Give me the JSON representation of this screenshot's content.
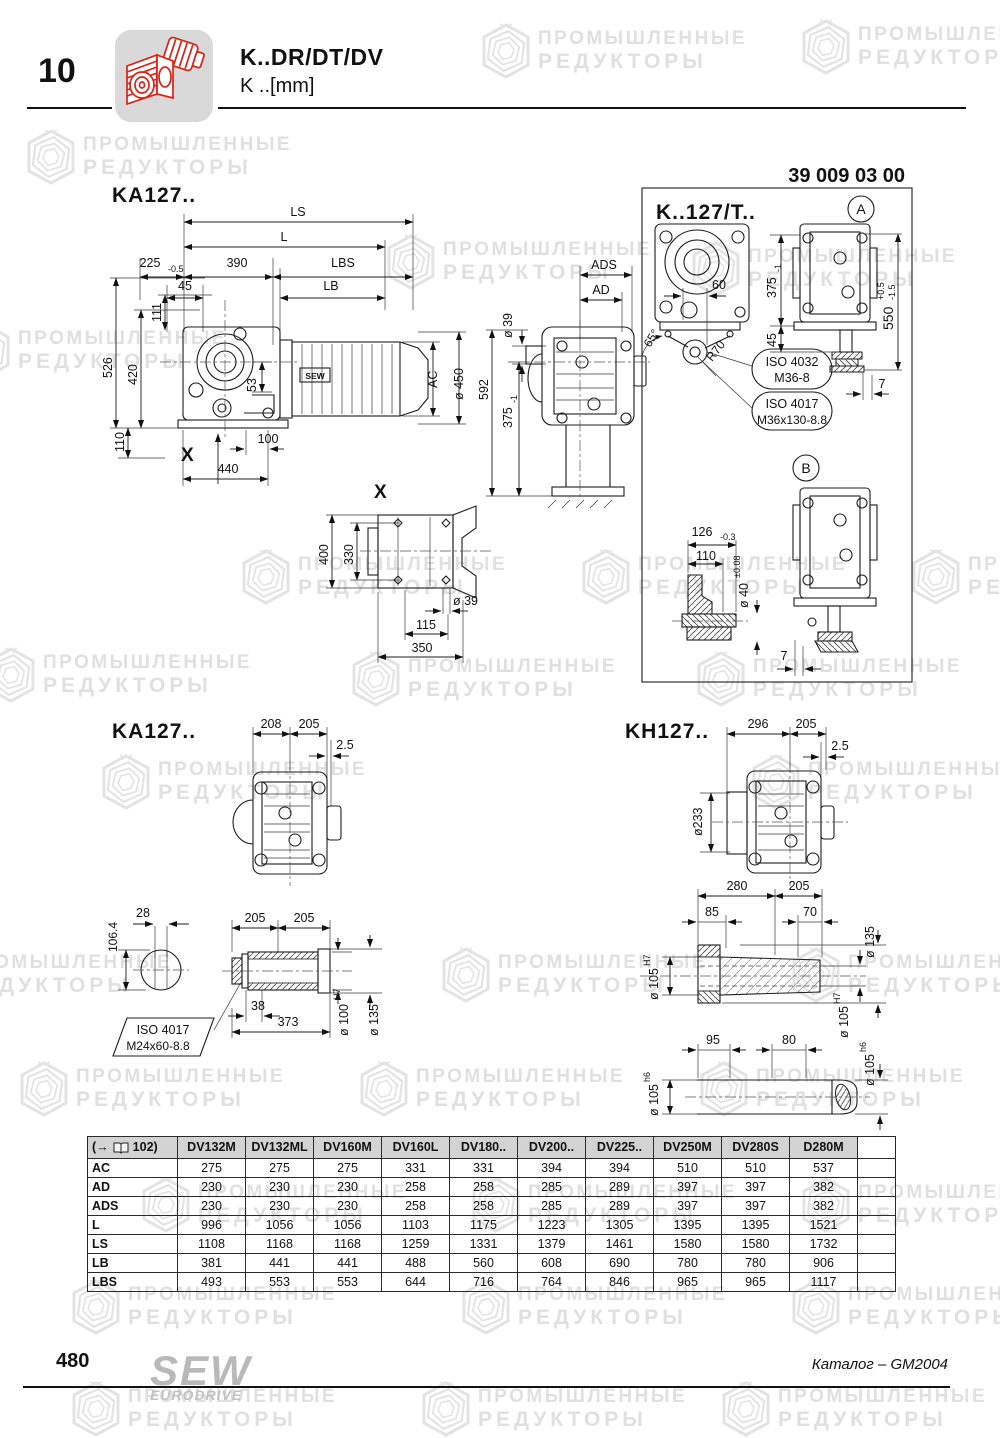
{
  "header": {
    "section_number": "10",
    "title": "K..DR/DT/DV",
    "subtitle": "K ..[mm]",
    "part_number": "39 009 03 00"
  },
  "watermark": {
    "line1": "ПРОМЫШЛЕННЫЕ",
    "line2": "РЕДУКТОРЫ"
  },
  "drawings": {
    "ka127_top": {
      "title": "KA127..",
      "motor_label": "SEW",
      "section_marker": "X",
      "dims": {
        "ls": "LS",
        "l": "L",
        "d225": "225",
        "d225_tol": "-0.5",
        "d390": "390",
        "lbs": "LBS",
        "d45": "45",
        "lb": "LB",
        "d111": "111",
        "d526": "526",
        "d420": "420",
        "d53": "53",
        "d110": "110",
        "d440": "440",
        "d100": "100",
        "ac": "AC",
        "d450": "ø 450"
      }
    },
    "rear": {
      "dims": {
        "ads": "ADS",
        "ad": "AD",
        "d39": "ø 39",
        "d592": "592",
        "d375": "375",
        "d375_tol": "-1"
      }
    },
    "x_view": {
      "title": "X",
      "dims": {
        "d400": "400",
        "d330": "330",
        "d39": "ø 39",
        "d115": "115",
        "d350": "350"
      }
    },
    "k127t": {
      "title": "K..127/T..",
      "marker_a": "A",
      "marker_b": "B",
      "dims": {
        "d60": "60",
        "a65": "65°",
        "r70": "R70",
        "d375": "375",
        "d375_tol": "-1",
        "d45": "45",
        "d550": "550",
        "d550_tol_up": "+0.5",
        "d550_tol_dn": "-1.5",
        "d7a": "7",
        "d126": "126",
        "d126_tol": "-0.3",
        "d110": "110",
        "d40": "ø 40",
        "d40_tol": "±0.08",
        "d7b": "7"
      },
      "callout1": {
        "line1": "ISO 4032",
        "line2": "M36-8"
      },
      "callout2": {
        "line1": "ISO 4017",
        "line2": "M36x130-8.8"
      }
    },
    "ka127_flange": {
      "title": "KA127..",
      "dims": {
        "d208": "208",
        "d205": "205",
        "d25": "2.5"
      }
    },
    "shaft": {
      "dims": {
        "d28": "28",
        "d1064": "106.4",
        "d205a": "205",
        "d205b": "205",
        "d38": "38",
        "d373": "373",
        "d100": "ø 100",
        "d100_fit": "H7",
        "d135": "ø 135"
      },
      "callout": {
        "line1": "ISO 4017",
        "line2": "M24x60-8.8"
      }
    },
    "kh127": {
      "title": "KH127..",
      "dims": {
        "d296": "296",
        "d205": "205",
        "d25": "2.5",
        "d233": "ø233"
      }
    },
    "kh_shaft": {
      "dims": {
        "d280": "280",
        "d205": "205",
        "d85": "85",
        "d70": "70",
        "d135": "ø 135",
        "d105l": "ø 105",
        "d105l_fit": "H7",
        "d105r": "ø 105",
        "d105r_fit": "H7",
        "d95": "95",
        "d80": "80",
        "d105bl": "ø 105",
        "d105bl_fit": "h6",
        "d105br": "ø 105",
        "d105br_fit": "h6"
      }
    }
  },
  "table": {
    "ref_prefix": "(→",
    "ref_suffix": "102)",
    "columns": [
      "DV132M",
      "DV132ML",
      "DV160M",
      "DV160L",
      "DV180..",
      "DV200..",
      "DV225..",
      "DV250M",
      "DV280S",
      "D280M"
    ],
    "rows": [
      {
        "label": "AC",
        "values": [
          "275",
          "275",
          "275",
          "331",
          "331",
          "394",
          "394",
          "510",
          "510",
          "537"
        ]
      },
      {
        "label": "AD",
        "values": [
          "230",
          "230",
          "230",
          "258",
          "258",
          "285",
          "289",
          "397",
          "397",
          "382"
        ]
      },
      {
        "label": "ADS",
        "values": [
          "230",
          "230",
          "230",
          "258",
          "258",
          "285",
          "289",
          "397",
          "397",
          "382"
        ]
      },
      {
        "label": "L",
        "values": [
          "996",
          "1056",
          "1056",
          "1103",
          "1175",
          "1223",
          "1305",
          "1395",
          "1395",
          "1521"
        ]
      },
      {
        "label": "LS",
        "values": [
          "1108",
          "1168",
          "1168",
          "1259",
          "1331",
          "1379",
          "1461",
          "1580",
          "1580",
          "1732"
        ]
      },
      {
        "label": "LB",
        "values": [
          "381",
          "441",
          "441",
          "488",
          "560",
          "608",
          "690",
          "780",
          "780",
          "906"
        ]
      },
      {
        "label": "LBS",
        "values": [
          "493",
          "553",
          "553",
          "644",
          "716",
          "764",
          "846",
          "965",
          "965",
          "1117"
        ]
      }
    ]
  },
  "footer": {
    "page_number": "480",
    "logo_line1": "SEW",
    "logo_line2": "EURODRIVE",
    "right_text": "Каталог – GM2004"
  }
}
